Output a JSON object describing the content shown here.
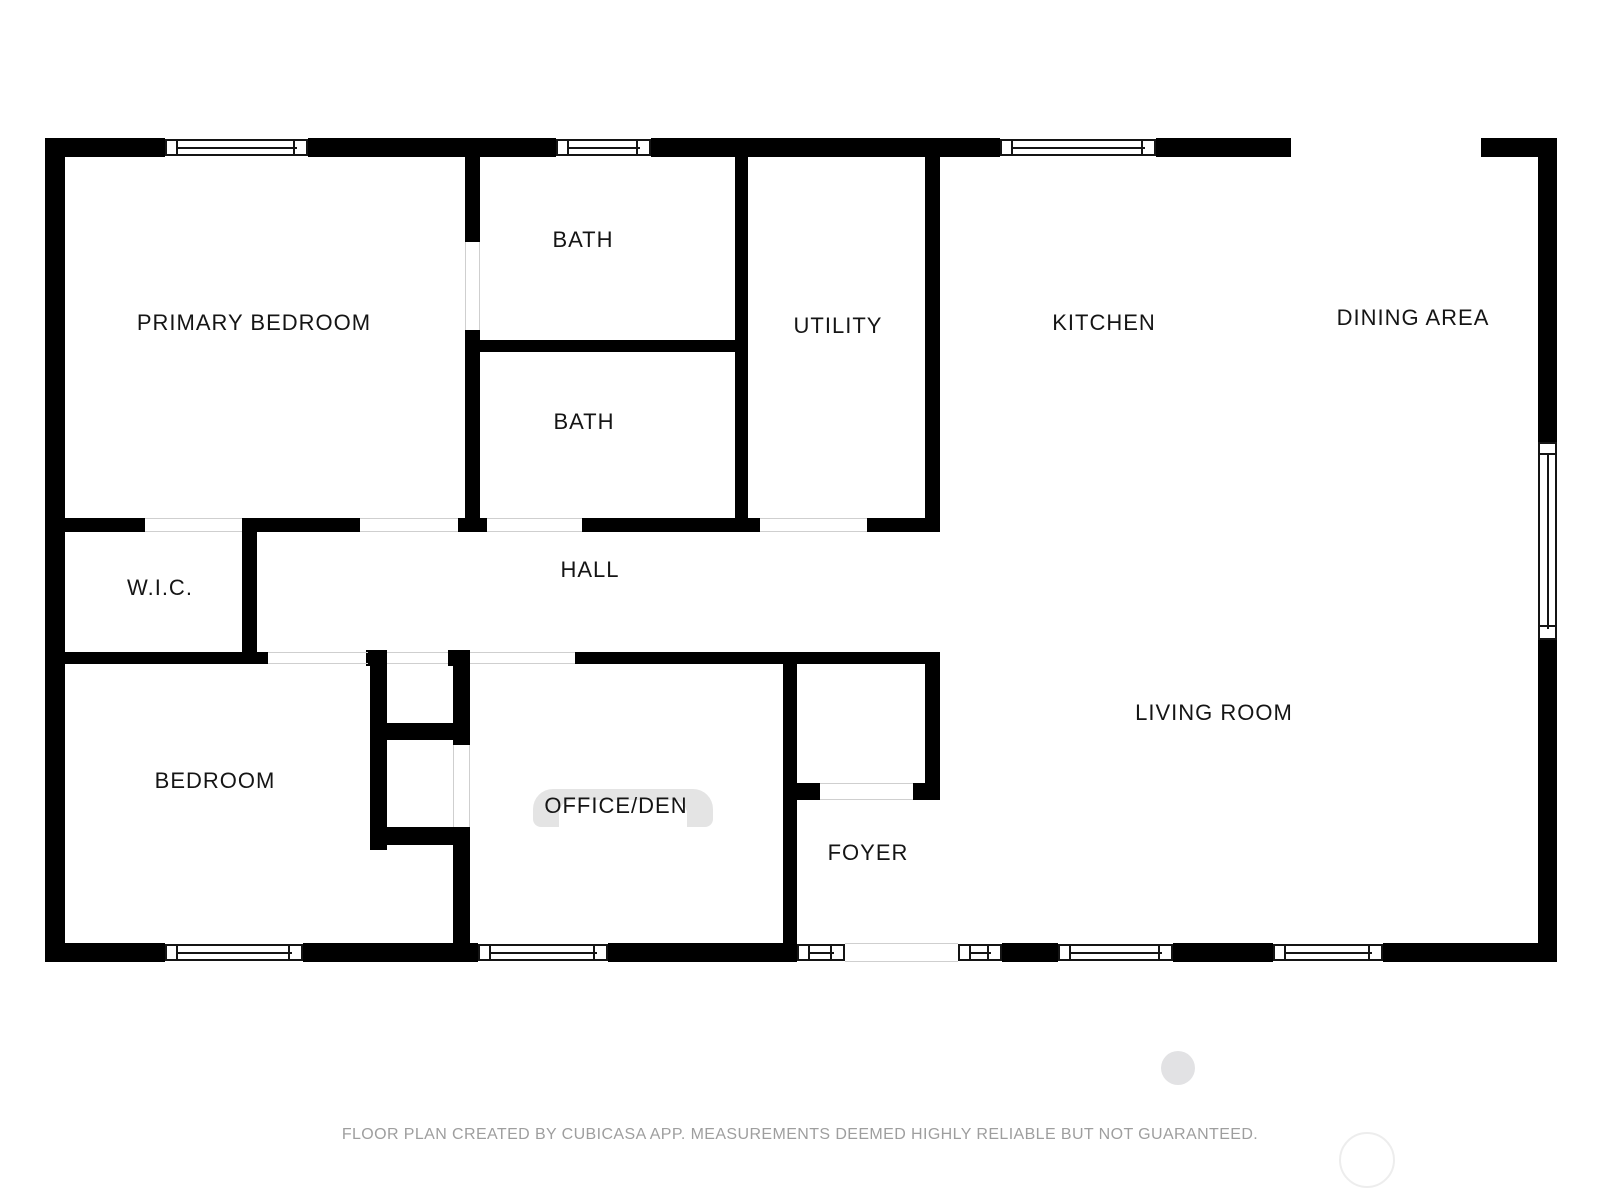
{
  "rooms": [
    {
      "id": "primary-bedroom",
      "label": "PRIMARY BEDROOM"
    },
    {
      "id": "bath-upper",
      "label": "BATH"
    },
    {
      "id": "bath-lower",
      "label": "BATH"
    },
    {
      "id": "utility",
      "label": "UTILITY"
    },
    {
      "id": "kitchen",
      "label": "KITCHEN"
    },
    {
      "id": "dining-area",
      "label": "DINING AREA"
    },
    {
      "id": "wic",
      "label": "W.I.C."
    },
    {
      "id": "hall",
      "label": "HALL"
    },
    {
      "id": "bedroom",
      "label": "BEDROOM"
    },
    {
      "id": "office-den",
      "label": "OFFICE/DEN"
    },
    {
      "id": "foyer",
      "label": "FOYER"
    },
    {
      "id": "living-room",
      "label": "LIVING ROOM"
    }
  ],
  "footer": {
    "disclaimer": "FLOOR PLAN CREATED BY CUBICASA APP. MEASUREMENTS DEEMED HIGHLY RELIABLE BUT NOT GUARANTEED."
  },
  "colors": {
    "wall": "#000000",
    "opening_line": "#cfcfcf",
    "arc": "#e4e4e4",
    "footer_text": "#9e9e9e",
    "watermark_fill": "#e2e2e4",
    "watermark_ring": "#ededed"
  }
}
